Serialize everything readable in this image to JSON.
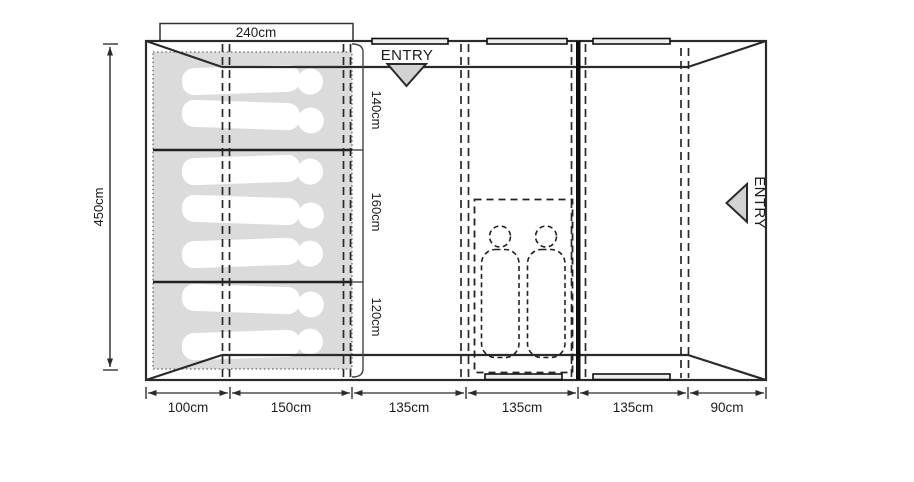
{
  "diagram_type": "tent-floor-plan",
  "entries": {
    "top": "ENTRY",
    "right": "ENTRY"
  },
  "dimensions": {
    "top_width": "240cm",
    "left_height": "450cm",
    "right_sections": [
      "140cm",
      "160cm",
      "120cm"
    ],
    "bottom_widths": [
      "100cm",
      "150cm",
      "135cm",
      "135cm",
      "135cm",
      "90cm"
    ]
  },
  "figures": {
    "sleeping_positions": 7,
    "bedroom_occupants": 2
  },
  "colors": {
    "line": "#2a2a2a",
    "mat_fill": "#dbdbdb",
    "arrow_fill": "#d2d2d2",
    "divider": "#0d0d0d"
  }
}
